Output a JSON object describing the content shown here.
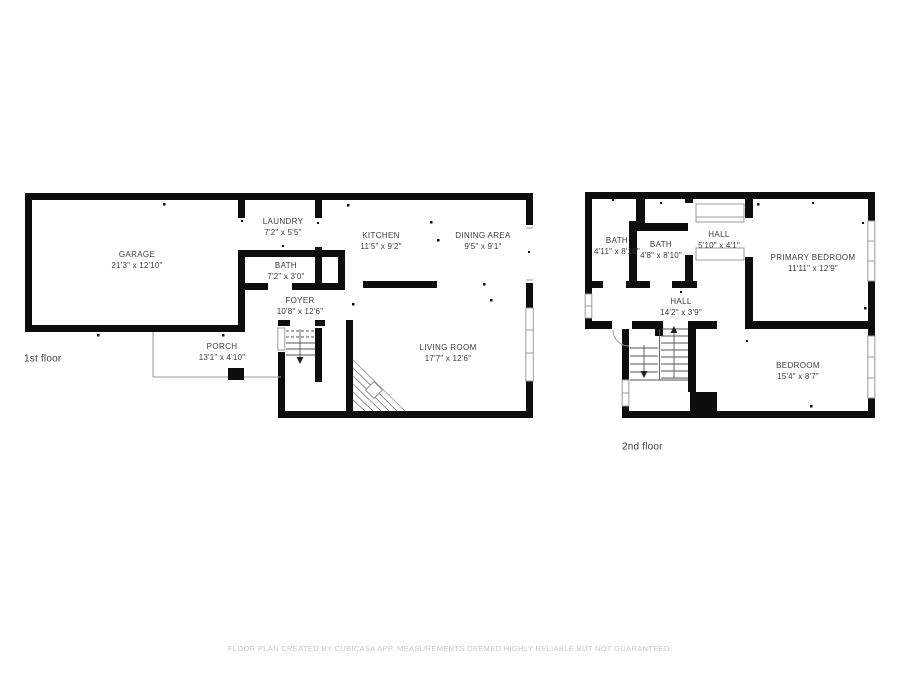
{
  "floors": [
    {
      "label": "1st floor",
      "rooms": [
        {
          "name": "GARAGE",
          "dims": "21'3\" x 12'10\""
        },
        {
          "name": "LAUNDRY",
          "dims": "7'2\" x 5'5\""
        },
        {
          "name": "BATH",
          "dims": "7'2\" x 3'0\""
        },
        {
          "name": "KITCHEN",
          "dims": "11'5\" x 9'2\""
        },
        {
          "name": "DINING AREA",
          "dims": "9'5\" x 9'1\""
        },
        {
          "name": "FOYER",
          "dims": "10'8\" x 12'6\""
        },
        {
          "name": "PORCH",
          "dims": "13'1\" x 4'10\""
        },
        {
          "name": "LIVING ROOM",
          "dims": "17'7\" x 12'6\""
        }
      ]
    },
    {
      "label": "2nd floor",
      "rooms": [
        {
          "name": "BATH",
          "dims": "4'11\" x 8'10\""
        },
        {
          "name": "BATH",
          "dims": "4'8\" x 8'10\""
        },
        {
          "name": "HALL",
          "dims": "5'10\" x 4'1\""
        },
        {
          "name": "PRIMARY BEDROOM",
          "dims": "11'11\" x 12'9\""
        },
        {
          "name": "HALL",
          "dims": "14'2\" x 3'9\""
        },
        {
          "name": "BEDROOM",
          "dims": "15'4\" x 8'7\""
        }
      ]
    }
  ],
  "footer": {
    "disclaimer": "FLOOR PLAN CREATED BY CUBICASA APP. MEASUREMENTS DEEMED HIGHLY RELIABLE BUT NOT GUARANTEED."
  },
  "colors": {
    "wall": "#0d0d0d",
    "thin_line": "#9b9b9b",
    "stair_line": "#555555",
    "label_text": "#3b3b3b",
    "footer_text": "#c7c7c7",
    "background": "#ffffff"
  }
}
